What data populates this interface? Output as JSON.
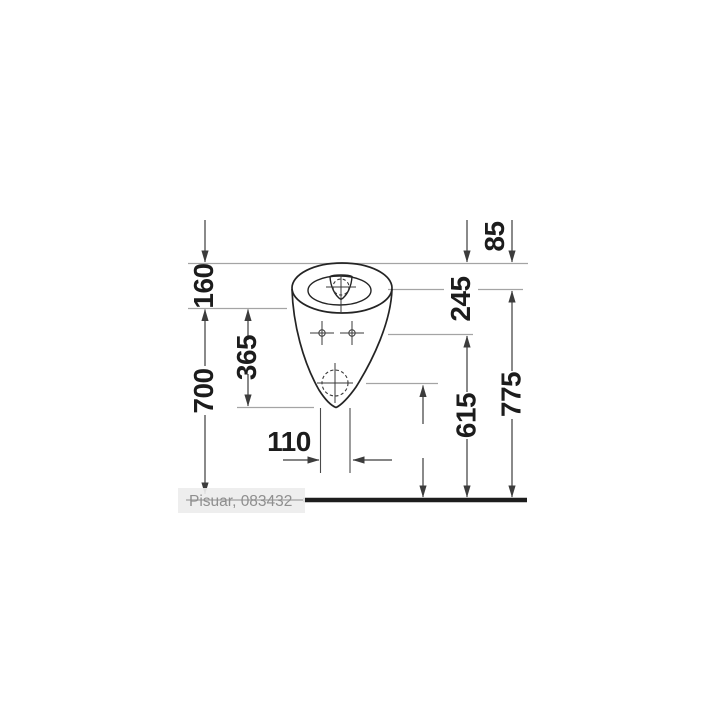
{
  "caption": {
    "label": "Pisuar, 083432"
  },
  "diagram": {
    "kind": "technical-dimension-drawing",
    "subject": "wall-hung-urinal-front-view",
    "units": "mm",
    "dims": {
      "d85": "85",
      "d160": "160",
      "d245": "245",
      "d365": "365",
      "d700": "700",
      "d110": "110",
      "d430": "430",
      "d615": "615",
      "d775": "775"
    },
    "colors": {
      "background": "#ffffff",
      "outline": "#242424",
      "dimension_line": "#3c3c3c",
      "reference_line": "#a4a4a4",
      "label_text": "#1c1c1c",
      "floor_line": "#1d1d1d",
      "caption_text": "#8f8f8f",
      "caption_background": "#ededed"
    }
  }
}
